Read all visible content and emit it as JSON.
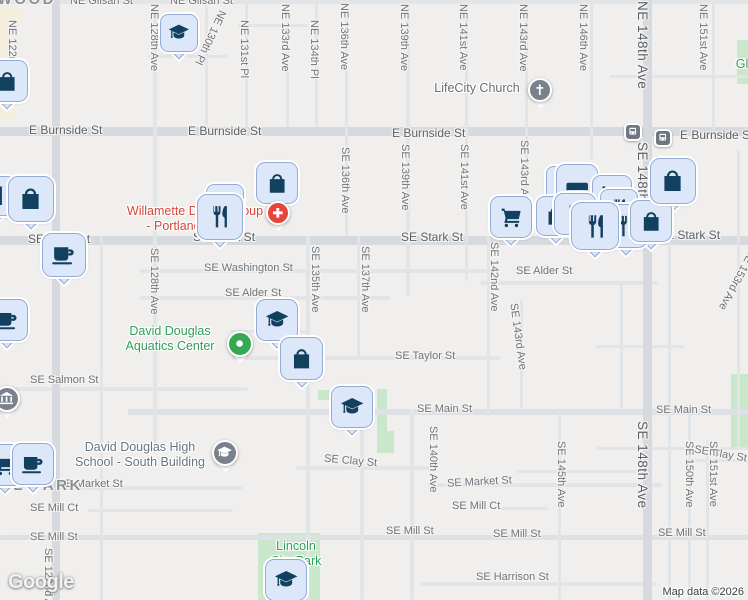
{
  "map": {
    "logo": "Google",
    "attribution": "Map data ©2026",
    "colors": {
      "background": "#f0efed",
      "road": "#e2e5e8",
      "road_major": "#d6dade",
      "park": "#c9e7cb",
      "commercial": "#f6eedd",
      "pin_fill": "#dce7f9",
      "pin_border": "#94abd5",
      "pin_glyph": "#12405f",
      "poi_red": "#e8453a",
      "poi_green": "#34a853",
      "poi_gray": "#79828c",
      "badge_gray": "#6e7680"
    },
    "commercial": [
      {
        "x": 0,
        "y": 26,
        "w": 13,
        "h": 94
      },
      {
        "x": 0,
        "y": 8,
        "w": 22,
        "h": 18
      }
    ],
    "parks": [
      {
        "x": 258,
        "y": 533,
        "w": 62,
        "h": 67
      },
      {
        "x": 318,
        "y": 390,
        "w": 19,
        "h": 10
      },
      {
        "x": 377,
        "y": 389,
        "w": 10,
        "h": 64
      },
      {
        "x": 377,
        "y": 431,
        "w": 17,
        "h": 22
      },
      {
        "x": 731,
        "y": 374,
        "w": 17,
        "h": 76
      },
      {
        "x": 737,
        "y": 40,
        "w": 11,
        "h": 44
      }
    ],
    "roads_h": [
      {
        "y": 0,
        "x": 0,
        "len": 748,
        "t": 4
      },
      {
        "y": 24,
        "x": 238,
        "len": 70,
        "t": 3
      },
      {
        "y": 55,
        "x": 148,
        "len": 80,
        "t": 3
      },
      {
        "y": 75,
        "x": 610,
        "len": 138,
        "t": 3
      },
      {
        "y": 127,
        "x": 0,
        "len": 748,
        "t": 9,
        "major": true
      },
      {
        "y": 205,
        "x": 0,
        "len": 52,
        "t": 3
      },
      {
        "y": 236,
        "x": 0,
        "len": 748,
        "t": 9,
        "major": true
      },
      {
        "y": 269,
        "x": 140,
        "len": 357,
        "t": 4
      },
      {
        "y": 281,
        "x": 480,
        "len": 178,
        "t": 4
      },
      {
        "y": 296,
        "x": 140,
        "len": 250,
        "t": 4
      },
      {
        "y": 330,
        "x": 230,
        "len": 76,
        "t": 3
      },
      {
        "y": 345,
        "x": 595,
        "len": 90,
        "t": 3
      },
      {
        "y": 356,
        "x": 232,
        "len": 268,
        "t": 4
      },
      {
        "y": 387,
        "x": 0,
        "len": 248,
        "t": 4
      },
      {
        "y": 409,
        "x": 128,
        "len": 620,
        "t": 6,
        "mid": true
      },
      {
        "y": 447,
        "x": 596,
        "len": 152,
        "t": 3
      },
      {
        "y": 466,
        "x": 296,
        "len": 134,
        "t": 4
      },
      {
        "y": 470,
        "x": 517,
        "len": 120,
        "t": 3
      },
      {
        "y": 459,
        "x": 688,
        "len": 60,
        "t": 3
      },
      {
        "y": 486,
        "x": 52,
        "len": 190,
        "t": 4
      },
      {
        "y": 483,
        "x": 428,
        "len": 234,
        "t": 4
      },
      {
        "y": 509,
        "x": 88,
        "len": 145,
        "t": 3
      },
      {
        "y": 507,
        "x": 500,
        "len": 48,
        "t": 3
      },
      {
        "y": 535,
        "x": 0,
        "len": 748,
        "t": 5,
        "mid": true
      },
      {
        "y": 582,
        "x": 420,
        "len": 236,
        "t": 4
      }
    ],
    "roads_v": [
      {
        "x": 52,
        "y": 0,
        "len": 600,
        "t": 8,
        "major": true
      },
      {
        "x": 100,
        "y": 236,
        "len": 364,
        "t": 3
      },
      {
        "x": 153,
        "y": 0,
        "len": 452,
        "t": 4
      },
      {
        "x": 205,
        "y": 0,
        "len": 127,
        "t": 3
      },
      {
        "x": 245,
        "y": 0,
        "len": 127,
        "t": 3
      },
      {
        "x": 286,
        "y": 24,
        "len": 103,
        "t": 3
      },
      {
        "x": 315,
        "y": 0,
        "len": 127,
        "t": 3
      },
      {
        "x": 345,
        "y": 0,
        "len": 236,
        "t": 3
      },
      {
        "x": 306,
        "y": 236,
        "len": 364,
        "t": 4
      },
      {
        "x": 357,
        "y": 236,
        "len": 124,
        "t": 3
      },
      {
        "x": 360,
        "y": 430,
        "len": 170,
        "t": 4
      },
      {
        "x": 406,
        "y": 0,
        "len": 296,
        "t": 4
      },
      {
        "x": 410,
        "y": 409,
        "len": 191,
        "t": 4
      },
      {
        "x": 465,
        "y": 0,
        "len": 281,
        "t": 3
      },
      {
        "x": 487,
        "y": 236,
        "len": 180,
        "t": 3
      },
      {
        "x": 525,
        "y": 0,
        "len": 236,
        "t": 3
      },
      {
        "x": 520,
        "y": 300,
        "len": 110,
        "t": 3
      },
      {
        "x": 558,
        "y": 409,
        "len": 191,
        "t": 3
      },
      {
        "x": 590,
        "y": 0,
        "len": 160,
        "t": 3
      },
      {
        "x": 620,
        "y": 283,
        "len": 126,
        "t": 3
      },
      {
        "x": 643,
        "y": 0,
        "len": 600,
        "t": 9,
        "major": true
      },
      {
        "x": 668,
        "y": 236,
        "len": 364,
        "t": 3
      },
      {
        "x": 688,
        "y": 409,
        "len": 191,
        "t": 3
      },
      {
        "x": 712,
        "y": 0,
        "len": 130,
        "t": 3
      },
      {
        "x": 706,
        "y": 440,
        "len": 160,
        "t": 3
      },
      {
        "x": 737,
        "y": 150,
        "len": 300,
        "t": 3
      }
    ],
    "street_labels": [
      {
        "text": "NE Glisan St",
        "x": 70,
        "y": -5,
        "dir": "h"
      },
      {
        "text": "NE Glisan St",
        "x": 170,
        "y": -5,
        "dir": "h"
      },
      {
        "text": "E Burnside St",
        "x": 29,
        "y": 123,
        "dir": "h",
        "big": true
      },
      {
        "text": "E Burnside St",
        "x": 188,
        "y": 124,
        "dir": "h",
        "big": true
      },
      {
        "text": "E Burnside St",
        "x": 392,
        "y": 126,
        "dir": "h",
        "big": true
      },
      {
        "text": "E Burnside St",
        "x": 680,
        "y": 128,
        "dir": "h",
        "big": true
      },
      {
        "text": "SE Stark St",
        "x": 28,
        "y": 232,
        "dir": "h",
        "big": true
      },
      {
        "text": "SE Stark St",
        "x": 193,
        "y": 230,
        "dir": "h",
        "big": true
      },
      {
        "text": "SE Stark St",
        "x": 401,
        "y": 230,
        "dir": "h",
        "big": true
      },
      {
        "text": "SE Stark St",
        "x": 658,
        "y": 228,
        "dir": "h",
        "big": true
      },
      {
        "text": "SE Washington St",
        "x": 204,
        "y": 262,
        "dir": "h"
      },
      {
        "text": "SE Alder St",
        "x": 225,
        "y": 287,
        "dir": "h"
      },
      {
        "text": "SE Alder St",
        "x": 516,
        "y": 265,
        "dir": "h"
      },
      {
        "text": "SE Taylor St",
        "x": 395,
        "y": 350,
        "dir": "h"
      },
      {
        "text": "SE Salmon St",
        "x": 30,
        "y": 374,
        "dir": "h"
      },
      {
        "text": "SE Main St",
        "x": 417,
        "y": 403,
        "dir": "h"
      },
      {
        "text": "SE Main St",
        "x": 656,
        "y": 404,
        "dir": "h"
      },
      {
        "text": "SE Clay St",
        "x": 324,
        "y": 455,
        "dir": "h",
        "rot": 5
      },
      {
        "text": "SE Clay St",
        "x": 694,
        "y": 448,
        "dir": "h",
        "rot": 10
      },
      {
        "text": "SE Market St",
        "x": 58,
        "y": 478,
        "dir": "h"
      },
      {
        "text": "SE Market St",
        "x": 447,
        "y": 476,
        "dir": "h",
        "rot": -3
      },
      {
        "text": "SE Mill Ct",
        "x": 30,
        "y": 502,
        "dir": "h"
      },
      {
        "text": "SE Mill Ct",
        "x": 452,
        "y": 500,
        "dir": "h"
      },
      {
        "text": "SE Mill St",
        "x": 30,
        "y": 531,
        "dir": "h"
      },
      {
        "text": "SE Mill St",
        "x": 386,
        "y": 525,
        "dir": "h"
      },
      {
        "text": "SE Mill St",
        "x": 493,
        "y": 528,
        "dir": "h"
      },
      {
        "text": "SE Mill St",
        "x": 658,
        "y": 527,
        "dir": "h"
      },
      {
        "text": "SE Harrison St",
        "x": 476,
        "y": 571,
        "dir": "h"
      },
      {
        "text": "NE 122nd Ave",
        "x": 6,
        "y": 20,
        "dir": "v"
      },
      {
        "text": "NE 128th Ave",
        "x": 148,
        "y": 4,
        "dir": "v"
      },
      {
        "text": "NE 130th Pl",
        "x": 204,
        "y": 8,
        "dir": "v",
        "rot": 25
      },
      {
        "text": "NE 131st Pl",
        "x": 238,
        "y": 20,
        "dir": "v"
      },
      {
        "text": "NE 133rd Ave",
        "x": 279,
        "y": 4,
        "dir": "v"
      },
      {
        "text": "NE 134th Pl",
        "x": 308,
        "y": 20,
        "dir": "v"
      },
      {
        "text": "NE 136th Ave",
        "x": 338,
        "y": 3,
        "dir": "v"
      },
      {
        "text": "NE 139th Ave",
        "x": 398,
        "y": 4,
        "dir": "v"
      },
      {
        "text": "NE 141st Ave",
        "x": 457,
        "y": 4,
        "dir": "v"
      },
      {
        "text": "NE 143rd Ave",
        "x": 517,
        "y": 4,
        "dir": "v"
      },
      {
        "text": "NE 146th Ave",
        "x": 577,
        "y": 4,
        "dir": "v"
      },
      {
        "text": "NE 148th Ave",
        "x": 635,
        "y": 1,
        "dir": "v",
        "big": true
      },
      {
        "text": "NE 151st Ave",
        "x": 697,
        "y": 4,
        "dir": "v"
      },
      {
        "text": "SE 136th Ave",
        "x": 339,
        "y": 147,
        "dir": "v"
      },
      {
        "text": "SE 139th Ave",
        "x": 399,
        "y": 144,
        "dir": "v"
      },
      {
        "text": "SE 141st Ave",
        "x": 458,
        "y": 144,
        "dir": "v"
      },
      {
        "text": "SE 143rd Ave",
        "x": 518,
        "y": 140,
        "dir": "v"
      },
      {
        "text": "SE 148th Ave",
        "x": 635,
        "y": 142,
        "dir": "v",
        "big": true
      },
      {
        "text": "SE 128th Ave",
        "x": 148,
        "y": 248,
        "dir": "v"
      },
      {
        "text": "SE 135th Ave",
        "x": 309,
        "y": 246,
        "dir": "v"
      },
      {
        "text": "SE 137th Ave",
        "x": 359,
        "y": 246,
        "dir": "v"
      },
      {
        "text": "SE 142nd Ave",
        "x": 488,
        "y": 242,
        "dir": "v"
      },
      {
        "text": "SE 143rd Ave",
        "x": 512,
        "y": 303,
        "dir": "v",
        "rot": -8
      },
      {
        "text": "SE 153rd Ave",
        "x": 731,
        "y": 246,
        "dir": "v",
        "rot": 28
      },
      {
        "text": "SE 140th Ave",
        "x": 427,
        "y": 426,
        "dir": "v"
      },
      {
        "text": "SE 145th Ave",
        "x": 555,
        "y": 441,
        "dir": "v"
      },
      {
        "text": "SE 148th Ave",
        "x": 635,
        "y": 421,
        "dir": "v",
        "big": true
      },
      {
        "text": "SE 150th Ave",
        "x": 683,
        "y": 441,
        "dir": "v"
      },
      {
        "text": "SE 151st Ave",
        "x": 707,
        "y": 441,
        "dir": "v"
      },
      {
        "text": "SE 122nd Ave",
        "x": 42,
        "y": 548,
        "dir": "v"
      }
    ],
    "area_labels": [
      {
        "text": "HAZELWOOD",
        "x": -64,
        "y": -9
      },
      {
        "text": "MILL PARK",
        "x": -20,
        "y": 477
      }
    ],
    "poi_labels": [
      {
        "lines": [
          "LifeCity Church"
        ],
        "cx": 477,
        "y": 81,
        "cls": "gray"
      },
      {
        "lines": [
          "Willamette Dental Group",
          "- Portland Stark 1"
        ],
        "cx": 195,
        "y": 204,
        "cls": "red"
      },
      {
        "lines": [
          "David Douglas",
          "Aquatics Center"
        ],
        "cx": 170,
        "y": 324,
        "cls": "green"
      },
      {
        "lines": [
          "David Douglas High",
          "School - South Building"
        ],
        "cx": 140,
        "y": 440,
        "cls": "slate"
      },
      {
        "lines": [
          "Lincoln",
          "City Park"
        ],
        "cx": 296,
        "y": 539,
        "cls": "green"
      },
      {
        "lines": [
          "Gl"
        ],
        "cx": 742,
        "y": 57,
        "cls": "green"
      }
    ],
    "pins": [
      {
        "icon": "restaurant",
        "x": -24,
        "y": 176,
        "s": 40
      },
      {
        "icon": "shopping-bag",
        "x": 8,
        "y": 176,
        "s": 46
      },
      {
        "icon": "coffee",
        "x": 42,
        "y": 233,
        "s": 44
      },
      {
        "icon": "shopping-bag",
        "x": -14,
        "y": 60,
        "s": 42
      },
      {
        "icon": "coffee",
        "x": -14,
        "y": 299,
        "s": 42
      },
      {
        "icon": "graduation-cap",
        "x": 160,
        "y": 14,
        "s": 38
      },
      {
        "icon": "restaurant",
        "x": 206,
        "y": 184,
        "s": 38
      },
      {
        "icon": "restaurant",
        "x": 197,
        "y": 194,
        "s": 46
      },
      {
        "icon": "shopping-bag",
        "x": 256,
        "y": 162,
        "s": 42
      },
      {
        "kind": "circle",
        "icon": "medical-cross",
        "x": 266,
        "y": 201,
        "d": 24,
        "color": "red"
      },
      {
        "icon": "shopping-cart",
        "x": 490,
        "y": 196,
        "s": 42
      },
      {
        "icon": "home",
        "x": 546,
        "y": 166,
        "s": 34
      },
      {
        "icon": "lodging",
        "x": 556,
        "y": 164,
        "s": 42
      },
      {
        "icon": "shopping-cart",
        "x": 592,
        "y": 175,
        "s": 40
      },
      {
        "icon": "restaurant",
        "x": 600,
        "y": 189,
        "s": 38
      },
      {
        "icon": "shopping-bag",
        "x": 536,
        "y": 196,
        "s": 40
      },
      {
        "icon": "restaurant",
        "x": 554,
        "y": 193,
        "s": 42
      },
      {
        "icon": "restaurant",
        "x": 604,
        "y": 204,
        "s": 44
      },
      {
        "icon": "shopping-bag",
        "x": 630,
        "y": 200,
        "s": 42
      },
      {
        "icon": "restaurant",
        "x": 571,
        "y": 202,
        "s": 48
      },
      {
        "icon": "shopping-bag",
        "x": 650,
        "y": 158,
        "s": 46
      },
      {
        "kind": "badge",
        "icon": "bus",
        "x": 624,
        "y": 123,
        "d": 18
      },
      {
        "kind": "badge",
        "icon": "bus",
        "x": 654,
        "y": 129,
        "d": 18
      },
      {
        "kind": "circle",
        "icon": "church-cross",
        "x": 528,
        "y": 78,
        "d": 24,
        "color": "gray"
      },
      {
        "kind": "circle",
        "icon": "dot",
        "x": 227,
        "y": 331,
        "d": 26,
        "color": "green"
      },
      {
        "kind": "circle",
        "icon": "graduation-cap",
        "x": 212,
        "y": 440,
        "d": 26,
        "color": "gray"
      },
      {
        "kind": "circle",
        "icon": "museum",
        "x": -6,
        "y": 386,
        "d": 26,
        "color": "gray"
      },
      {
        "icon": "graduation-cap",
        "x": 256,
        "y": 299,
        "s": 42
      },
      {
        "icon": "shopping-bag",
        "x": 280,
        "y": 337,
        "s": 43
      },
      {
        "icon": "graduation-cap",
        "x": 331,
        "y": 386,
        "s": 42
      },
      {
        "icon": "graduation-cap",
        "x": 265,
        "y": 559,
        "s": 42
      },
      {
        "icon": "shopping-cart",
        "x": -16,
        "y": 444,
        "s": 42
      },
      {
        "icon": "coffee",
        "x": 12,
        "y": 443,
        "s": 42
      }
    ]
  }
}
